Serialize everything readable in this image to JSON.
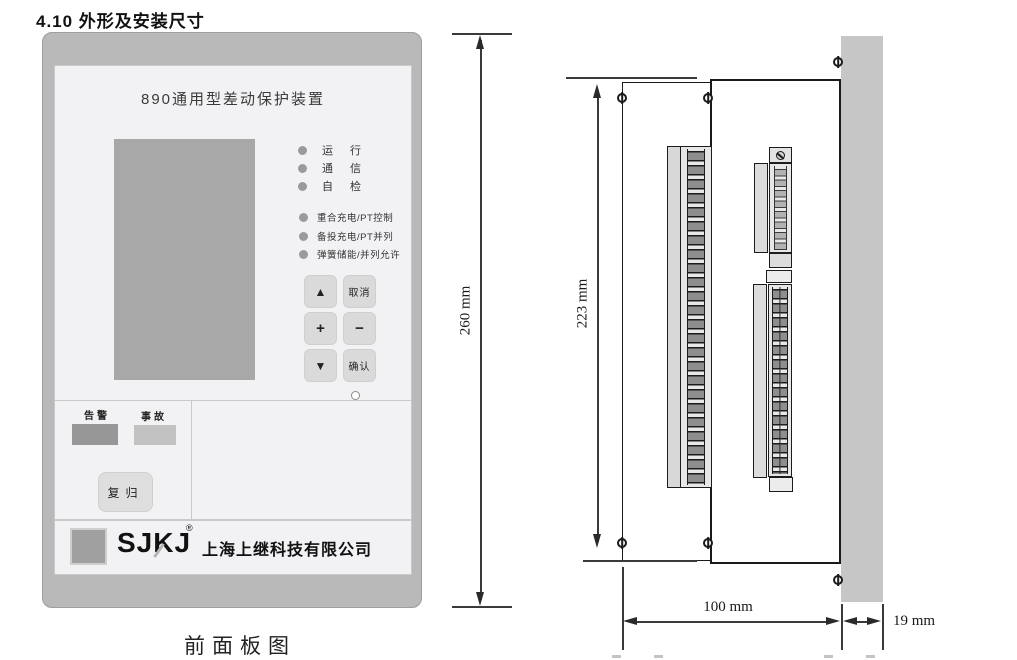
{
  "page": {
    "section_title": "4.10 外形及安装尺寸",
    "front_caption": "前面板图"
  },
  "front_panel": {
    "title": "890通用型差动保护装置",
    "status_leds": [
      {
        "label": "运 行"
      },
      {
        "label": "通 信"
      },
      {
        "label": "自 检"
      }
    ],
    "function_leds": [
      {
        "label": "重合充电/PT控制"
      },
      {
        "label": "备投充电/PT并列"
      },
      {
        "label": "弹簧储能/并列允许"
      }
    ],
    "keypad": [
      {
        "name": "up",
        "label": "▲"
      },
      {
        "name": "cancel",
        "label": "取消"
      },
      {
        "name": "plus",
        "label": "+"
      },
      {
        "name": "minus",
        "label": "−"
      },
      {
        "name": "down",
        "label": "▼"
      },
      {
        "name": "confirm",
        "label": "确认"
      }
    ],
    "alarm_label": "告警",
    "fault_label": "事故",
    "reset_label": "复归",
    "logo_text": "SJKJ",
    "logo_reg": "®",
    "company": "上海上继科技有限公司",
    "colors": {
      "frame": "#b9b9b9",
      "panel": "#f2f2f4",
      "lcd": "#a8a8a8",
      "alarm_lamp": "#979797",
      "fault_lamp": "#c2c2c2"
    }
  },
  "side_view": {
    "colors": {
      "mounting_panel": "#c6c6c6",
      "line": "#1a1a1a"
    }
  },
  "dimensions": {
    "overall_height": "260 mm",
    "case_height": "223 mm",
    "case_depth": "100 mm",
    "panel_thickness": "19 mm"
  }
}
